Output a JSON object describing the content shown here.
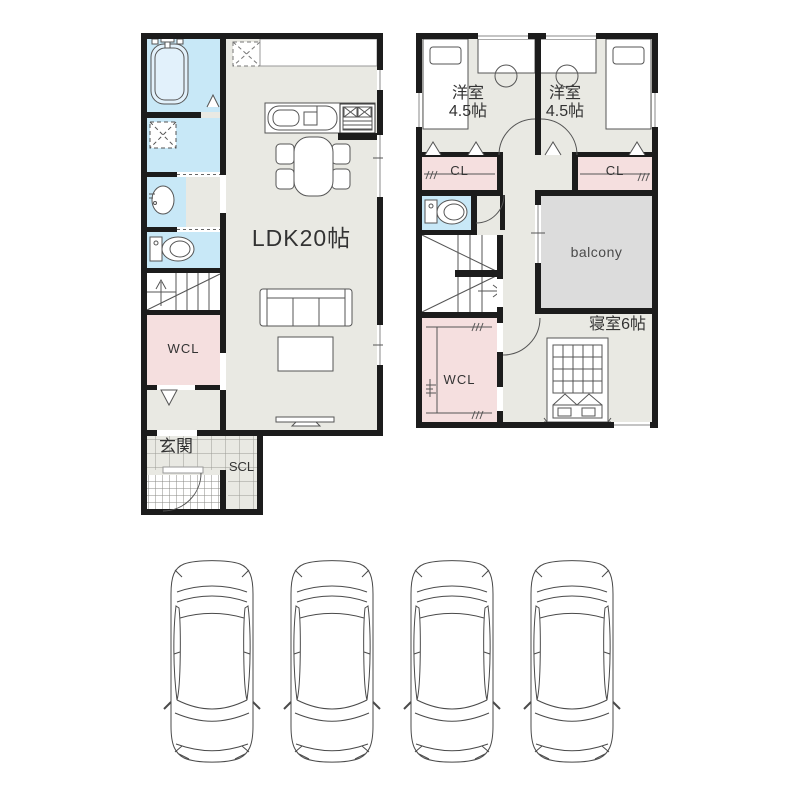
{
  "floor1": {
    "ldk_label": "LDK20帖",
    "wcl_label": "WCL",
    "entrance_label": "玄関",
    "scl_label": "SCL"
  },
  "floor2": {
    "room1_name": "洋室",
    "room1_size": "4.5帖",
    "room2_name": "洋室",
    "room2_size": "4.5帖",
    "cl_left_label": "CL",
    "cl_right_label": "CL",
    "balcony_label": "balcony",
    "bedroom_label": "寝室6帖",
    "wcl_label": "WCL"
  },
  "colors": {
    "wall": "#1c1c1c",
    "floor": "#e9e9e3",
    "water_blue": "#c8e8f7",
    "closet_pink": "#f5dfdf",
    "balcony_gray": "#dcdcdc",
    "outline": "#555555",
    "text": "#333333"
  }
}
